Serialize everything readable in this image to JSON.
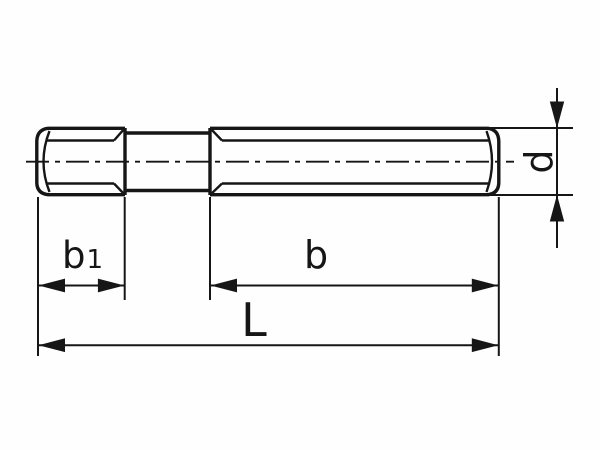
{
  "drawing": {
    "colors": {
      "background": "#fefefe",
      "line": "#161616"
    },
    "dimensions": {
      "b1": {
        "main": "b",
        "sub": "1"
      },
      "b": {
        "label": "b"
      },
      "length": {
        "label": "L"
      },
      "diameter": {
        "label": "d"
      }
    }
  }
}
